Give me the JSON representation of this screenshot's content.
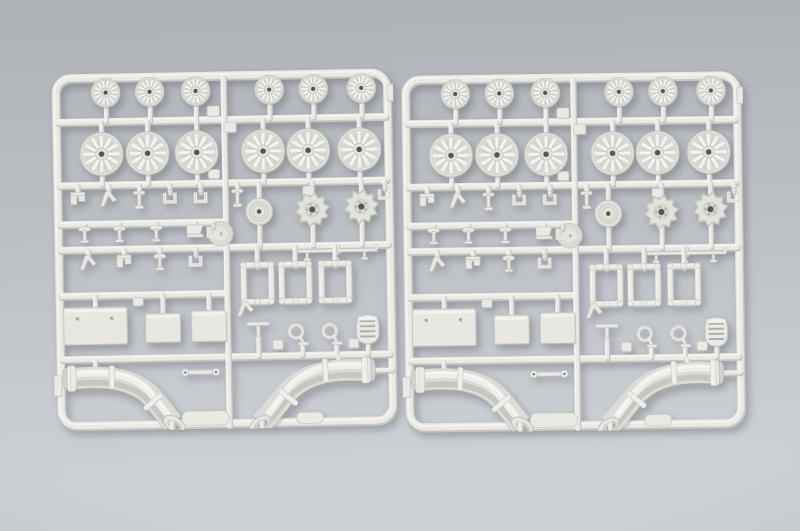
{
  "scene": {
    "kind": "product-photograph",
    "subject": "Two identical light-gray injection-molded plastic model-kit sprues with tank running-gear parts on a gray studio backdrop"
  },
  "palette": {
    "bg_top": "#aeb2b7",
    "bg_upper": "#b5b9be",
    "bg_mid": "#bdc1c6",
    "bg_lower": "#c7cbd0",
    "bg_bottom": "#ccd1d5",
    "plastic_highlight": "#f6f5f1",
    "plastic_base": "#eae9e4",
    "plastic_face": "#e3e2dd",
    "plastic_shadow": "#c6c5c0",
    "recess": "#b9b8b3",
    "hole_dark": "#56544f",
    "pipe_body": "#dcdbd7",
    "pipe_highlight": "#f0efeb",
    "pipe_shadow": "#c0bfbb"
  },
  "sprues": {
    "count": 2,
    "parts_each": {
      "small_road_wheels": 6,
      "large_road_wheels": 6,
      "drive_sprockets": 2,
      "idler_wheel": 1,
      "hub_cap_disc": 1,
      "rectangular_plates": 3,
      "open_frames": 3,
      "tow_loops": 2,
      "grille_cover": 1,
      "t_handle": 1,
      "link_bar": 1,
      "long_rail_fitting": 1,
      "exhaust_elbow_pipes": 2,
      "small_fittings": 16
    }
  }
}
